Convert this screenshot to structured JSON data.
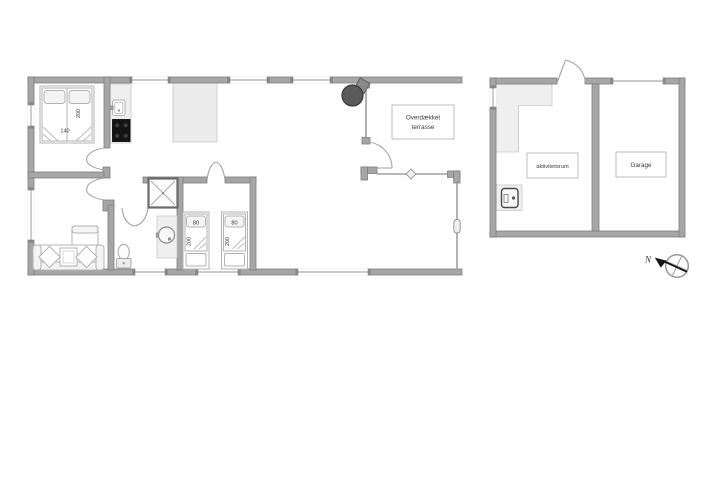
{
  "plan_labels": {
    "terrace_line1": "Overdækket",
    "terrace_line2": "terrasse",
    "activity_room": "aktivitetsrum",
    "garage": "Garage",
    "north": "N"
  },
  "bed_dimensions": {
    "double_width": "140",
    "double_length": "200",
    "single_width": "80",
    "single_length": "200"
  },
  "colors": {
    "wall": "#a6a6a6",
    "wall_edge": "#7d7d7d",
    "glass_line": "#9f9f9f",
    "furniture_line": "#b3b3b3",
    "counter_fill": "#efefef",
    "stove_black": "#141414",
    "wood_stove": "#5a5a5a",
    "label_text": "#3a3a3a",
    "north_arrow": "#151515",
    "background": "#ffffff"
  }
}
